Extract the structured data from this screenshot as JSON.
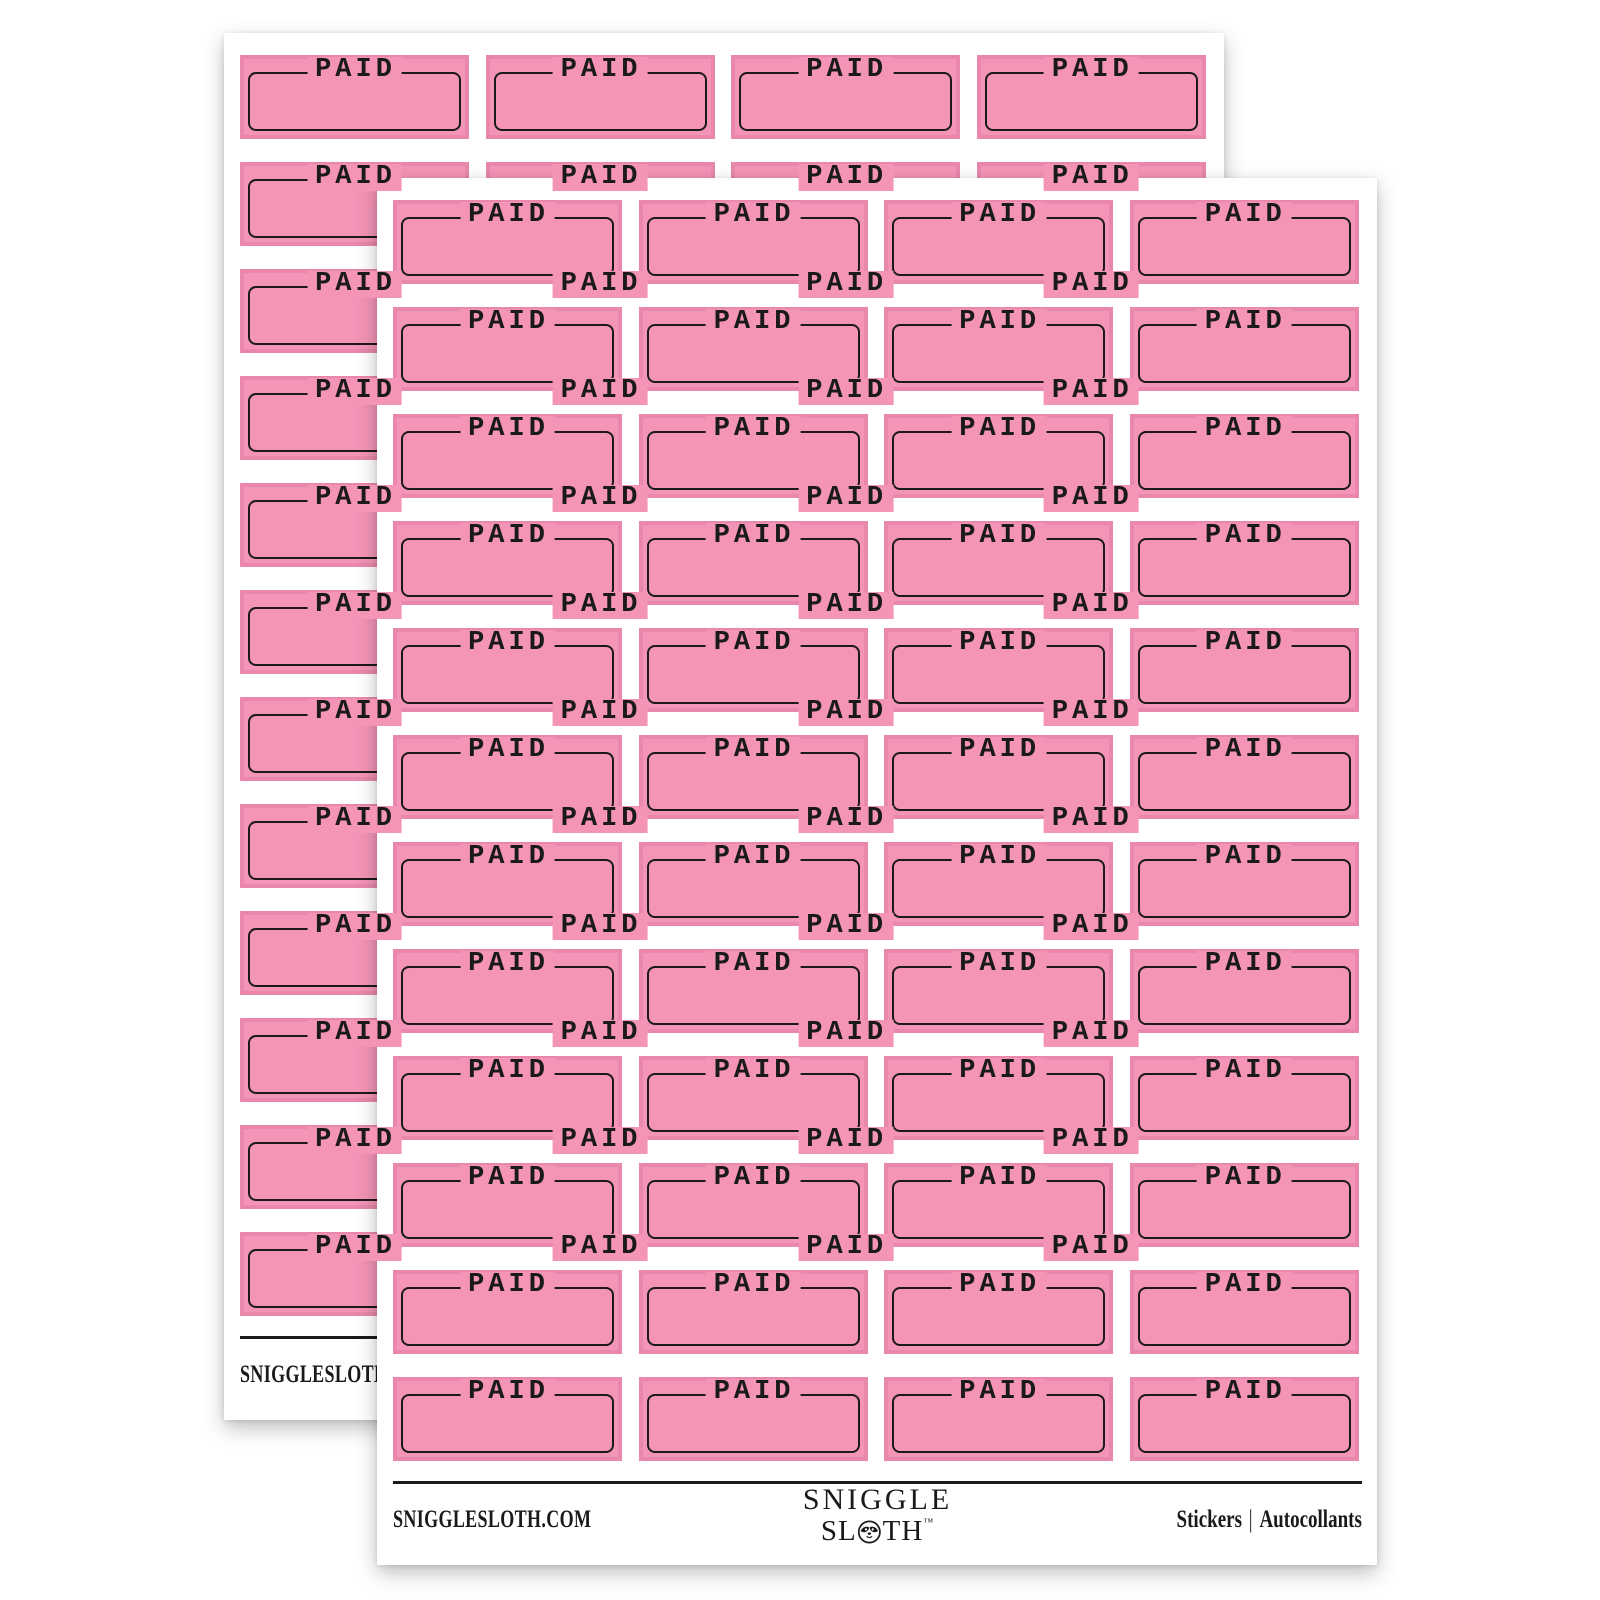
{
  "page": {
    "background": "#FFFFFF"
  },
  "sticker": {
    "label": "PAID"
  },
  "sheet": {
    "grid": {
      "rows": 12,
      "columns": 4
    },
    "footer": {
      "website": "SNIGGLESLOTH.COM",
      "brand_line1": "SNIGGLE",
      "brand_line2_start": "SL",
      "brand_line2_end": "TH",
      "brand_trademark": "™",
      "right_label_en": "Stickers",
      "right_separator": "|",
      "right_label_fr": "Autocollants"
    }
  },
  "colors": {
    "sticker_pink": "#F494B7",
    "ink_black": "#1A1A1A",
    "sheet_white": "#FFFFFF"
  }
}
